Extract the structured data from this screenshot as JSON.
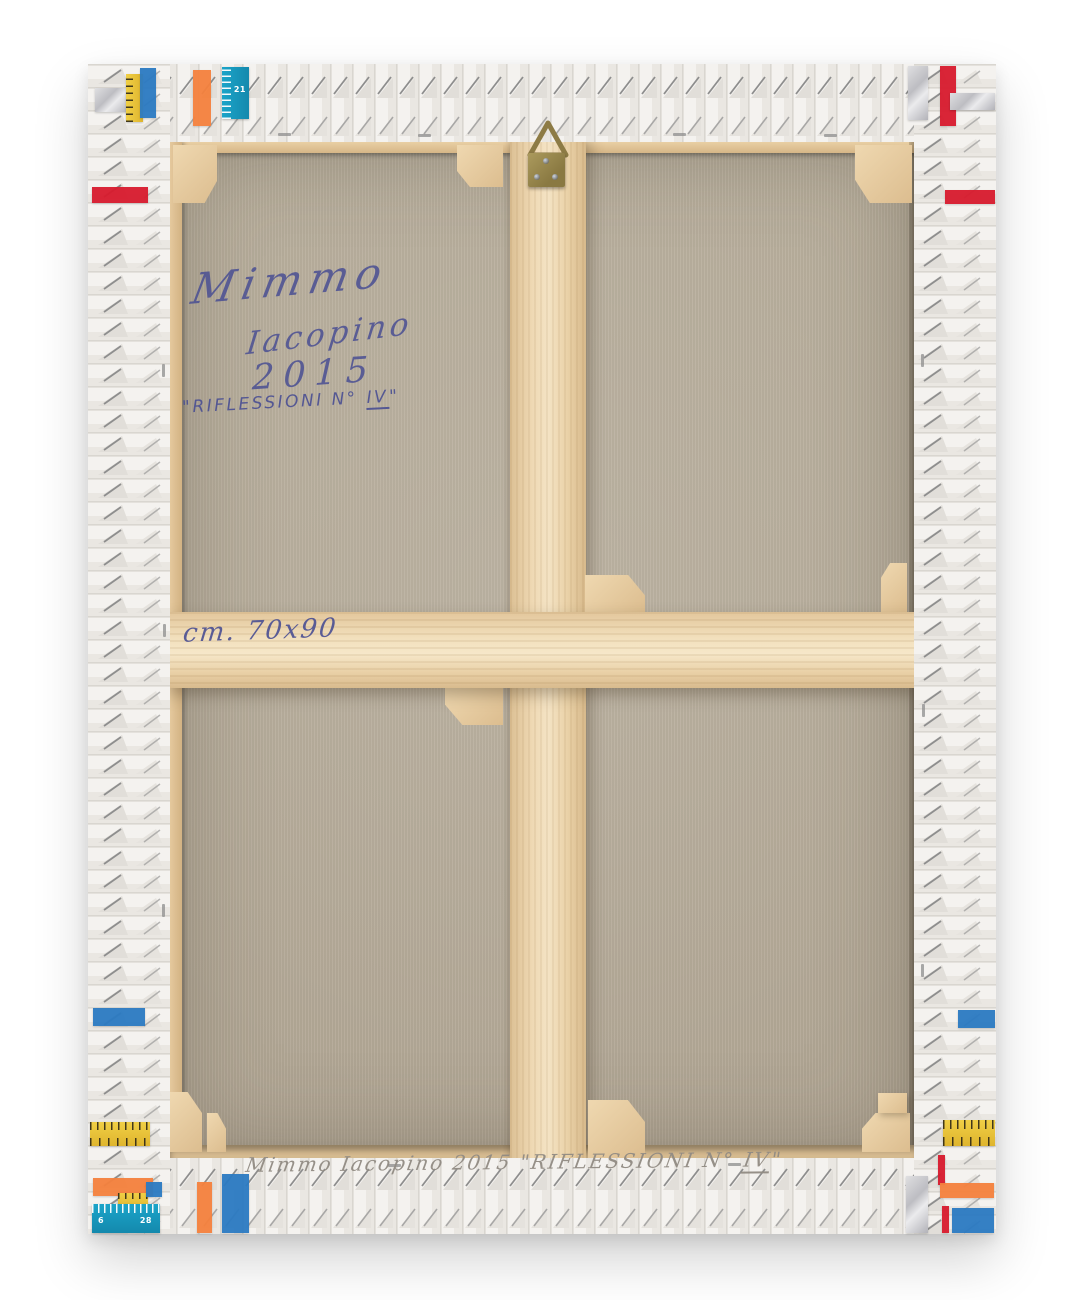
{
  "artwork": {
    "back_inscriptions": {
      "signature_name": "Mimmo",
      "signature_surname": "Iacopino",
      "year": "2015",
      "title_prefix": "\"RIFLESSIONI N° ",
      "title_numeral": "IV",
      "title_suffix": "\"",
      "size_note": "cm. 70x90",
      "bottom_prefix": "Mimmo   Iacopino   2015    \"RIFLESSIONI N° ",
      "bottom_numeral": "IV",
      "bottom_suffix": "\""
    },
    "ruler_numbers": {
      "top": "21",
      "bottom_a": "6",
      "bottom_b": "28"
    },
    "palette": {
      "canvas": "#b5ab99",
      "wood_light": "#f2e2c2",
      "wood_mid": "#e7cda3",
      "wood_dark": "#d6b789",
      "pleat_white": "#f4f2ef",
      "pen_blue": "#4a4f93",
      "pencil_gray": "#918b83",
      "brass": "#9c8a50",
      "tape_red": "#d81b2e",
      "tape_orange": "#f5813d",
      "tape_blue": "#2b7ac2",
      "tape_teal": "#189bc0",
      "tape_yellow": "#e9c53a",
      "tape_silver": "#c7c7cb"
    }
  }
}
